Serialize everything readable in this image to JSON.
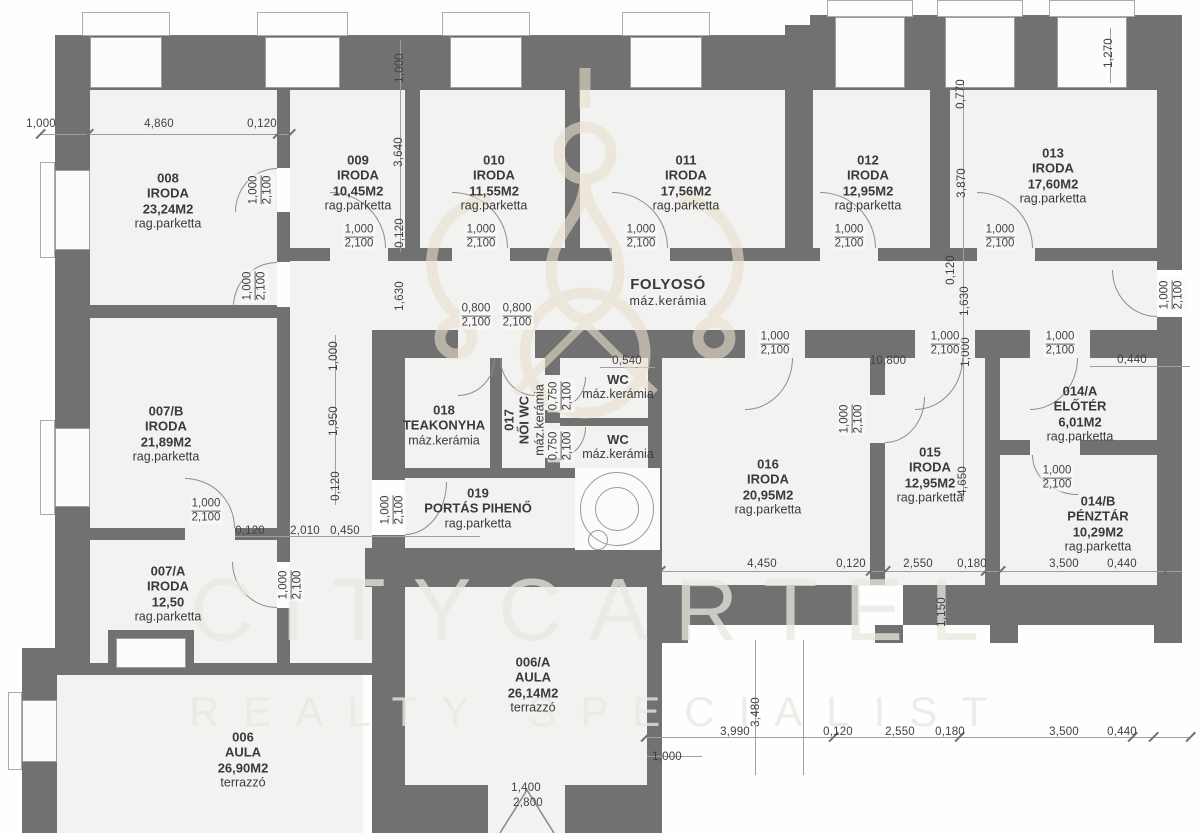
{
  "watermark": {
    "brand": "CITYCARTEL",
    "tagline": "REALTY SPECIALIST"
  },
  "rooms": [
    {
      "id": "008",
      "name": "IRODA",
      "area": "23,24M2",
      "floor": "rag.parketta",
      "x": 168,
      "y": 201
    },
    {
      "id": "009",
      "name": "IRODA",
      "area": "10,45M2",
      "floor": "rag.parketta",
      "x": 358,
      "y": 183
    },
    {
      "id": "010",
      "name": "IRODA",
      "area": "11,55M2",
      "floor": "rag.parketta",
      "x": 494,
      "y": 183
    },
    {
      "id": "011",
      "name": "IRODA",
      "area": "17,56M2",
      "floor": "rag.parketta",
      "x": 686,
      "y": 183
    },
    {
      "id": "012",
      "name": "IRODA",
      "area": "12,95M2",
      "floor": "rag.parketta",
      "x": 868,
      "y": 183
    },
    {
      "id": "013",
      "name": "IRODA",
      "area": "17,60M2",
      "floor": "rag.parketta",
      "x": 1053,
      "y": 176
    },
    {
      "id": "",
      "name": "FOLYOSÓ",
      "area": "",
      "floor": "máz.kerámia",
      "x": 668,
      "y": 292,
      "big": true
    },
    {
      "id": "007/B",
      "name": "IRODA",
      "area": "21,89M2",
      "floor": "rag.parketta",
      "x": 166,
      "y": 434
    },
    {
      "id": "007/A",
      "name": "IRODA",
      "area": "12,50",
      "floor": "rag.parketta",
      "x": 168,
      "y": 594
    },
    {
      "id": "006",
      "name": "AULA",
      "area": "26,90M2",
      "floor": "terrazzó",
      "x": 243,
      "y": 760
    },
    {
      "id": "006/A",
      "name": "AULA",
      "area": "26,14M2",
      "floor": "terrazzó",
      "x": 533,
      "y": 685
    },
    {
      "id": "018",
      "name": "TEAKONYHA",
      "area": "",
      "floor": "máz.kerámia",
      "x": 444,
      "y": 425
    },
    {
      "id": "017",
      "name": "NŐI WC",
      "area": "",
      "floor": "máz.kerámia",
      "x": 524,
      "y": 420,
      "vertical": true
    },
    {
      "id": "019",
      "name": "PORTÁS PIHENŐ",
      "area": "",
      "floor": "rag.parketta",
      "x": 478,
      "y": 508
    },
    {
      "id": "",
      "name": "WC",
      "area": "",
      "floor": "máz.kerámia",
      "x": 618,
      "y": 387
    },
    {
      "id": "",
      "name": "WC",
      "area": "",
      "floor": "máz.kerámia",
      "x": 618,
      "y": 447
    },
    {
      "id": "016",
      "name": "IRODA",
      "area": "20,95M2",
      "floor": "rag.parketta",
      "x": 768,
      "y": 487
    },
    {
      "id": "015",
      "name": "IRODA",
      "area": "12,95M2",
      "floor": "rag.parketta",
      "x": 930,
      "y": 475
    },
    {
      "id": "014/A",
      "name": "ELŐTÉR",
      "area": "6,01M2",
      "floor": "rag.parketta",
      "x": 1080,
      "y": 414
    },
    {
      "id": "014/B",
      "name": "PÉNZTÁR",
      "area": "10,29M2",
      "floor": "rag.parketta",
      "x": 1098,
      "y": 524
    }
  ],
  "dims": [
    {
      "t": "1,000",
      "x": 41,
      "y": 124
    },
    {
      "t": "4,860",
      "x": 159,
      "y": 124
    },
    {
      "t": "0,120",
      "x": 262,
      "y": 124
    },
    {
      "t": "1,000",
      "x": 400,
      "y": 68,
      "v": 1
    },
    {
      "t": "1,270",
      "x": 1109,
      "y": 53,
      "v": 1
    },
    {
      "t": "3,640",
      "x": 399,
      "y": 152,
      "v": 1
    },
    {
      "t": "0,120",
      "x": 400,
      "y": 233,
      "v": 1
    },
    {
      "t": "1,630",
      "x": 400,
      "y": 296,
      "v": 1
    },
    {
      "t": "0,770",
      "x": 961,
      "y": 94,
      "v": 1
    },
    {
      "t": "3,870",
      "x": 962,
      "y": 183,
      "v": 1
    },
    {
      "t": "0,120",
      "x": 951,
      "y": 270,
      "v": 1
    },
    {
      "t": "1,630",
      "x": 965,
      "y": 301,
      "v": 1
    },
    {
      "t": "1,000",
      "x": 966,
      "y": 352,
      "v": 1
    },
    {
      "t": "4,650",
      "x": 963,
      "y": 481,
      "v": 1
    },
    {
      "t": "1,150",
      "x": 942,
      "y": 612,
      "v": 1
    },
    {
      "t": "1,000",
      "x": 334,
      "y": 356,
      "v": 1
    },
    {
      "t": "1,950",
      "x": 334,
      "y": 421,
      "v": 1
    },
    {
      "t": "0,120",
      "x": 336,
      "y": 486,
      "v": 1
    },
    {
      "t": "0,120",
      "x": 250,
      "y": 531
    },
    {
      "t": "2,010",
      "x": 305,
      "y": 531
    },
    {
      "t": "0,450",
      "x": 345,
      "y": 531
    },
    {
      "t": "10,800",
      "x": 888,
      "y": 361
    },
    {
      "t": "0,540",
      "x": 627,
      "y": 361
    },
    {
      "t": "0,440",
      "x": 1132,
      "y": 360
    },
    {
      "t": "4,450",
      "x": 762,
      "y": 564
    },
    {
      "t": "0,120",
      "x": 851,
      "y": 564
    },
    {
      "t": "2,550",
      "x": 918,
      "y": 564
    },
    {
      "t": "0,180",
      "x": 972,
      "y": 564
    },
    {
      "t": "3,500",
      "x": 1064,
      "y": 564
    },
    {
      "t": "0,440",
      "x": 1122,
      "y": 564
    },
    {
      "t": "3,990",
      "x": 735,
      "y": 732
    },
    {
      "t": "3,480",
      "x": 756,
      "y": 712,
      "v": 1
    },
    {
      "t": "0,120",
      "x": 838,
      "y": 732
    },
    {
      "t": "2,550",
      "x": 900,
      "y": 732
    },
    {
      "t": "0,180",
      "x": 950,
      "y": 732
    },
    {
      "t": "3,500",
      "x": 1064,
      "y": 732
    },
    {
      "t": "0,440",
      "x": 1122,
      "y": 732
    },
    {
      "t": "1,000",
      "x": 667,
      "y": 757
    },
    {
      "t": "1,400",
      "x": 526,
      "y": 788
    },
    {
      "t": "2,800",
      "x": 528,
      "y": 803
    }
  ],
  "door_dims": [
    {
      "w": "1,000",
      "h": "2,100",
      "x": 359,
      "y": 237
    },
    {
      "w": "1,000",
      "h": "2,100",
      "x": 481,
      "y": 237
    },
    {
      "w": "1,000",
      "h": "2,100",
      "x": 641,
      "y": 237
    },
    {
      "w": "1,000",
      "h": "2,100",
      "x": 849,
      "y": 237
    },
    {
      "w": "1,000",
      "h": "2,100",
      "x": 1000,
      "y": 237
    },
    {
      "w": "1,000",
      "h": "2,100",
      "x": 775,
      "y": 344
    },
    {
      "w": "1,000",
      "h": "2,100",
      "x": 945,
      "y": 344
    },
    {
      "w": "1,000",
      "h": "2,100",
      "x": 1060,
      "y": 344
    },
    {
      "w": "1,000",
      "h": "2,100",
      "x": 206,
      "y": 511
    },
    {
      "w": "1,000",
      "h": "2,100",
      "x": 1057,
      "y": 478
    },
    {
      "w": "1,000",
      "h": "2,100",
      "x": 261,
      "y": 190,
      "v": 1
    },
    {
      "w": "1,000",
      "h": "2,100",
      "x": 255,
      "y": 286,
      "v": 1
    },
    {
      "w": "1,000",
      "h": "2,100",
      "x": 291,
      "y": 585,
      "v": 1
    },
    {
      "w": "1,000",
      "h": "2,100",
      "x": 393,
      "y": 510,
      "v": 1
    },
    {
      "w": "1,000",
      "h": "2,100",
      "x": 852,
      "y": 419,
      "v": 1
    },
    {
      "w": "1,000",
      "h": "2,100",
      "x": 1172,
      "y": 295,
      "v": 1
    },
    {
      "w": "0,800",
      "h": "2,100",
      "x": 476,
      "y": 316
    },
    {
      "w": "0,800",
      "h": "2,100",
      "x": 517,
      "y": 316
    },
    {
      "w": "0,750",
      "h": "2,100",
      "x": 561,
      "y": 396,
      "v": 1
    },
    {
      "w": "0,750",
      "h": "2,100",
      "x": 561,
      "y": 446,
      "v": 1
    }
  ]
}
